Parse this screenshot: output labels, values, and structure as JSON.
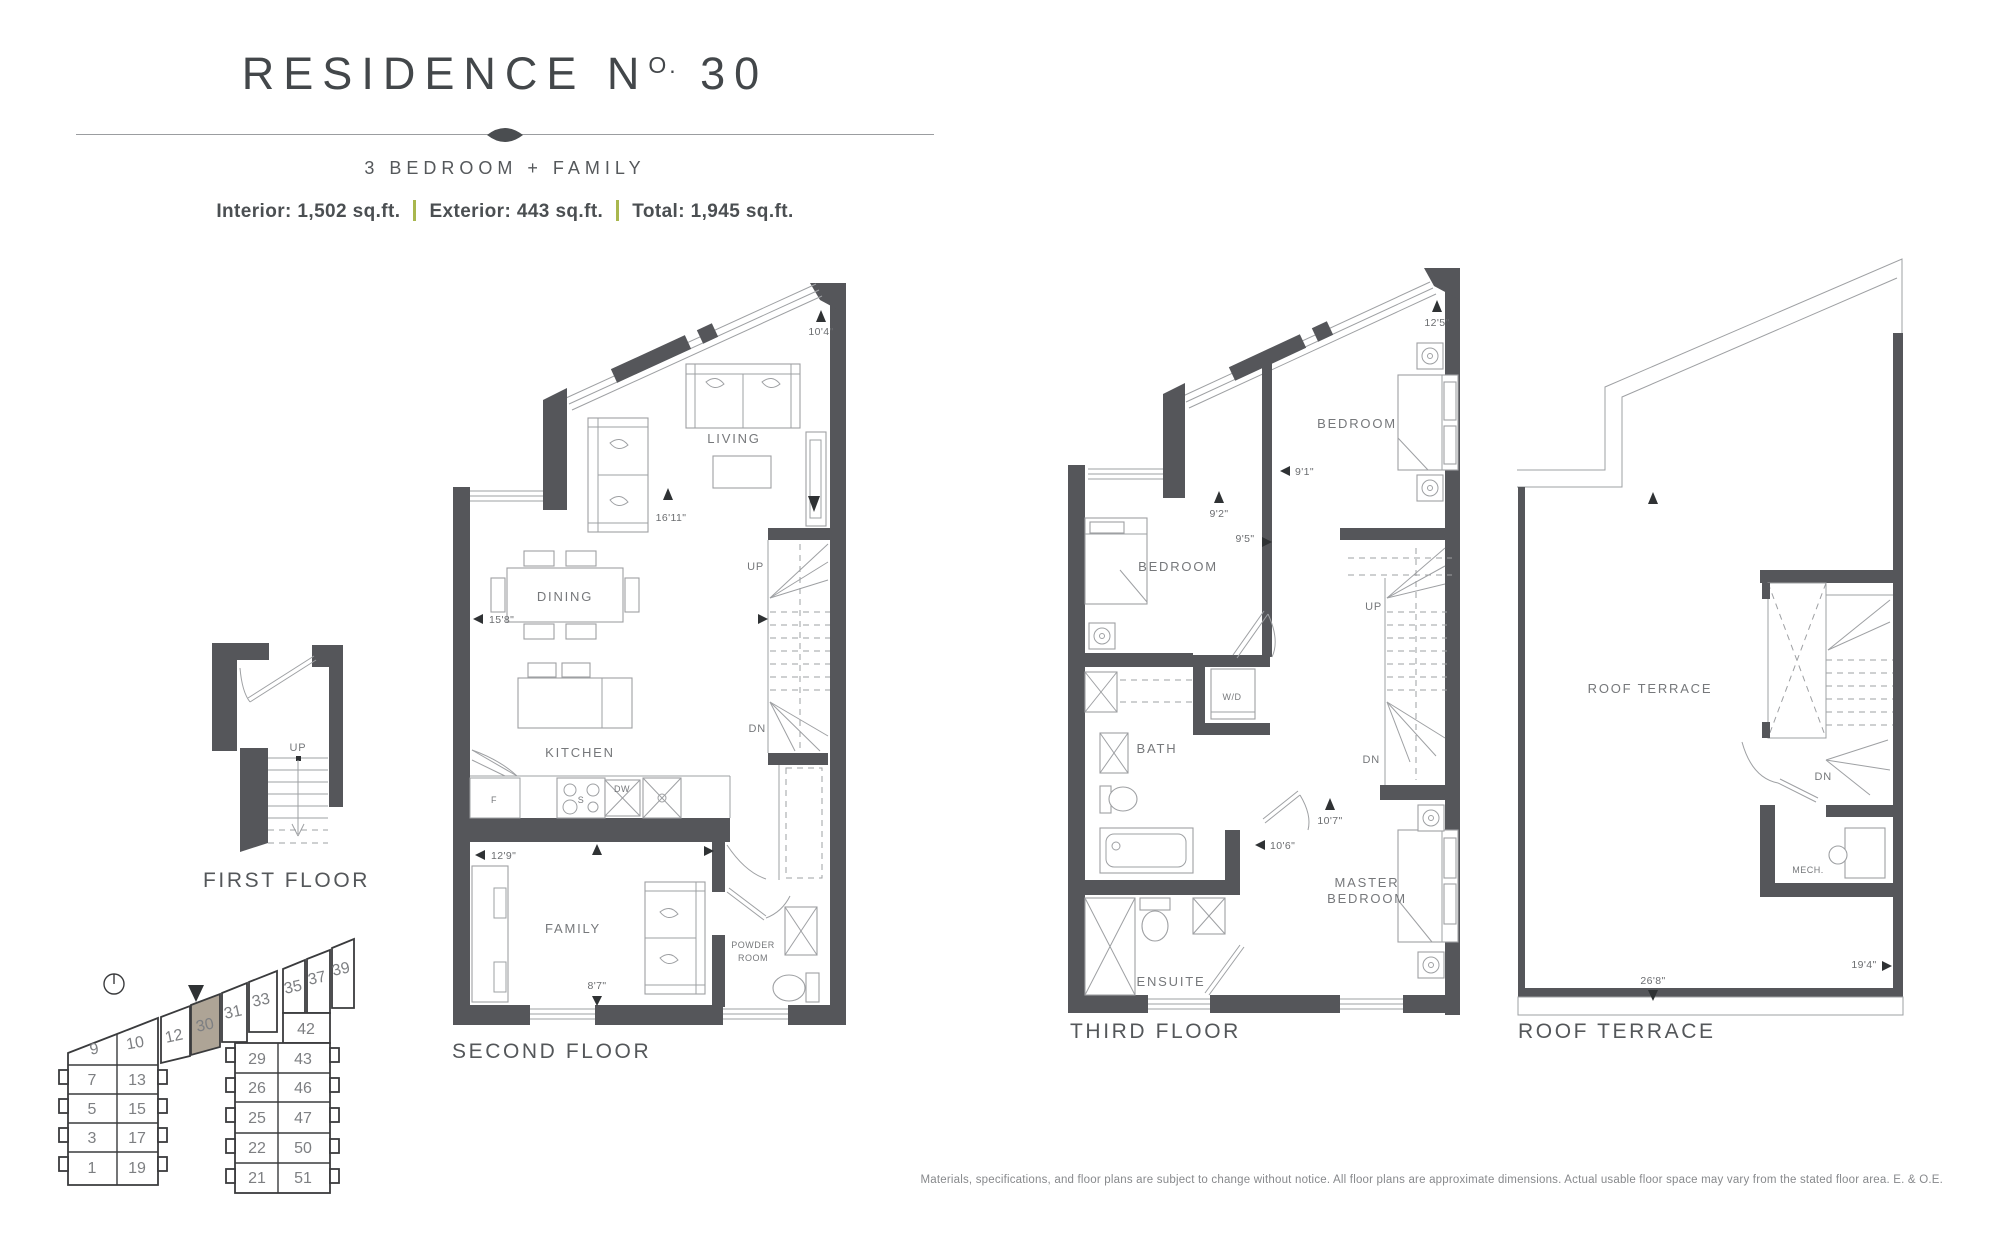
{
  "header": {
    "title_prefix": "RESIDENCE N",
    "title_sup": "O.",
    "title_number": " 30",
    "subtitle": "3 BEDROOM + FAMILY",
    "area_interior": "Interior: 1,502 sq.ft.",
    "area_exterior": "Exterior: 443 sq.ft.",
    "area_total": "Total: 1,945 sq.ft."
  },
  "floors": {
    "first": {
      "caption": "FIRST FLOOR",
      "up": "UP"
    },
    "second": {
      "caption": "SECOND FLOOR",
      "rooms": {
        "living": "LIVING",
        "dining": "DINING",
        "kitchen": "KITCHEN",
        "family": "FAMILY",
        "powder_line1": "POWDER",
        "powder_line2": "ROOM"
      },
      "appliances": {
        "fridge": "F",
        "dishwasher": "DW",
        "stove": "S"
      },
      "stairs": {
        "up": "UP",
        "down": "DN"
      },
      "dims": {
        "living_width": "10'4\"",
        "living_depth": "16'11\"",
        "dining_width": "15'8\"",
        "kitchen_width": "12'9\"",
        "family_width": "8'7\""
      }
    },
    "third": {
      "caption": "THIRD FLOOR",
      "rooms": {
        "bedroom2": "BEDROOM",
        "bedroom3": "BEDROOM",
        "bath": "BATH",
        "laundry": "W/D",
        "master_line1": "MASTER",
        "master_line2": "BEDROOM",
        "ensuite": "ENSUITE"
      },
      "stairs": {
        "up": "UP",
        "down": "DN"
      },
      "dims": {
        "bedroom2_width": "12'5\"",
        "hall_width": "9'1\"",
        "bedroom3_a": "9'2\"",
        "bedroom3_b": "9'5\"",
        "master_a": "10'7\"",
        "master_b": "10'6\""
      }
    },
    "roof": {
      "caption": "ROOF TERRACE",
      "rooms": {
        "terrace": "ROOF TERRACE",
        "mech": "MECH."
      },
      "stairs": {
        "down": "DN"
      },
      "dims": {
        "width": "26'8\"",
        "depth": "19'4\""
      }
    }
  },
  "keyplan": {
    "highlighted_unit": "30",
    "units": {
      "u9": "9",
      "u10": "10",
      "u12": "12",
      "u30": "30",
      "u31": "31",
      "u33": "33",
      "u35": "35",
      "u37": "37",
      "u39": "39",
      "u42": "42",
      "u29": "29",
      "u43": "43",
      "u26": "26",
      "u46": "46",
      "u25": "25",
      "u47": "47",
      "u22": "22",
      "u50": "50",
      "u21": "21",
      "u51": "51",
      "u7": "7",
      "u13": "13",
      "u5": "5",
      "u15": "15",
      "u3": "3",
      "u17": "17",
      "u1": "1",
      "u19": "19"
    }
  },
  "footer": {
    "disclaimer": "Materials, specifications, and floor plans are subject to change without notice. All floor plans are approximate dimensions. Actual usable floor space may vary from the stated floor area. E. & O.E."
  },
  "colors": {
    "wall": "#55565a",
    "line": "#9ea0a3",
    "accent_green": "#a9b74e",
    "highlight": "#aea496"
  }
}
